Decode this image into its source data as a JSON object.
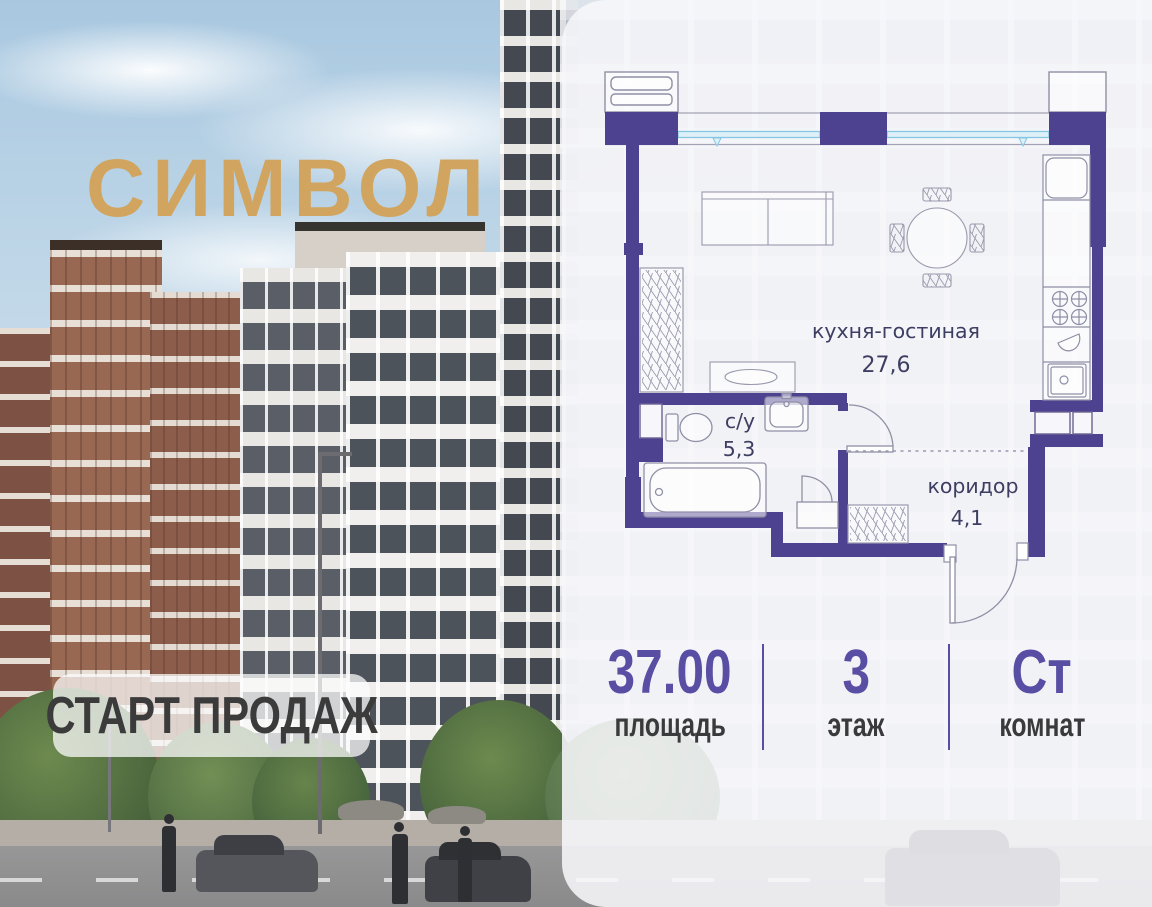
{
  "brand": {
    "logo": "СИМВОЛ",
    "badge": "СТАРТ ПРОДАЖ"
  },
  "floorplan": {
    "rooms": [
      {
        "name": "кухня-гостиная",
        "area": "27,6"
      },
      {
        "name": "с/у",
        "area": "5,3"
      },
      {
        "name": "коридор",
        "area": "4,1"
      }
    ],
    "colors": {
      "wall": "#4d4290",
      "window_glass": "#dff0f9",
      "window_frame": "#85c6e2",
      "line": "#8f8fa6",
      "label": "#3e3e62"
    }
  },
  "stats": [
    {
      "value": "37.00",
      "label": "площадь"
    },
    {
      "value": "3",
      "label": "этаж"
    },
    {
      "value": "Ст",
      "label": "комнат"
    }
  ],
  "colors": {
    "accent_gold": "#d1a55f",
    "stat_value": "#584ea3",
    "stat_label": "#3a3a3c",
    "badge_text": "#3b3b3b"
  }
}
